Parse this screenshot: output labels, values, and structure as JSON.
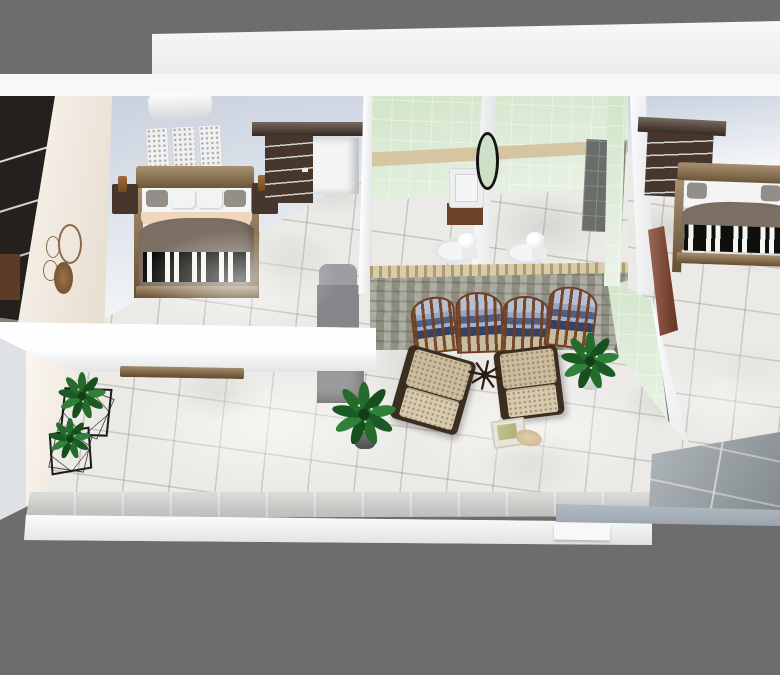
{
  "app": {
    "type": "3d-floorplan-render",
    "title": "Upper floor interior — bird's-eye 3D render",
    "visible_text": "none"
  },
  "palette": {
    "background": "#6e6c6d",
    "wall_white": "#f7f8f9",
    "wall_shadow": "#dfe2e5",
    "wall_blue": "#c9d1de",
    "wall_cream": "#f8efe2",
    "marble": "#ebeae7",
    "bathroom_green": "#cfe3c6",
    "tan_stripe": "#d6c5a2",
    "stone_wall": "#9fa092",
    "stone_cap": "#d9cba6",
    "wood": "#8a6a42",
    "dark_wood": "#46362b",
    "closet_dark": "#23201d",
    "blanket": "#7c7065",
    "sheet_trim": "#f0d6ba",
    "pillow_white": "#f2f3f5",
    "pillow_gray": "#938e87",
    "sofa_gray": "#85858a",
    "chair_beige": "#cbbc9e",
    "chair_seat": "#d8cbad",
    "chair_trim": "#3c2d21",
    "screen_sky": "#b6c0d2",
    "plant_green": "#246b2c",
    "door": "#83402a",
    "balcony": "#98a1a6",
    "platform_gray": "#9b9b9d",
    "fixture_white": "#f4f5f6",
    "vanity_wood": "#6b4226",
    "concrete": "#c9cac6",
    "dark_tile": "#6a6e6a",
    "shelf_wood": "#82643c"
  },
  "scene": {
    "view": "top-down isometric",
    "rooms": [
      {
        "id": "wardrobe-nook",
        "name": "Open wardrobe nook",
        "items": [
          "open shelving",
          "storage box"
        ]
      },
      {
        "id": "bedroom-left",
        "name": "Left bedroom",
        "items": [
          "double bed with striped runner",
          "two nightstands with lamps",
          "headboard wall panels",
          "window pelmet",
          "dark wardrobe unit",
          "white alcove desk",
          "gray sofa",
          "circle wall art"
        ]
      },
      {
        "id": "bathroom-left",
        "name": "Bathroom 1",
        "items": [
          "vanity sink",
          "oval mirror",
          "toilet"
        ]
      },
      {
        "id": "bathroom-right",
        "name": "Bathroom 2",
        "items": [
          "toilet",
          "dark shower tile panel"
        ]
      },
      {
        "id": "bedroom-right",
        "name": "Right bedroom",
        "items": [
          "double bed with striped runner",
          "dark wardrobe unit",
          "wooden door"
        ]
      },
      {
        "id": "lounge",
        "name": "Lounge",
        "items": [
          "four-panel landscape folding screen",
          "two beige armchairs",
          "star table decor",
          "potted plant",
          "monstera plant",
          "tray with cloth"
        ]
      },
      {
        "id": "hallway",
        "name": "Hallway",
        "items": [
          "wire cube planters",
          "wall shelf plank",
          "gray platform",
          "small wire rack"
        ]
      },
      {
        "id": "balcony",
        "name": "Balcony",
        "items": [
          "glass floor panels"
        ]
      }
    ],
    "counts": {
      "bedrooms": 2,
      "bathrooms": 2,
      "armchairs": 2,
      "toilets": 2,
      "plants": 4,
      "screen_panels": 4
    }
  }
}
